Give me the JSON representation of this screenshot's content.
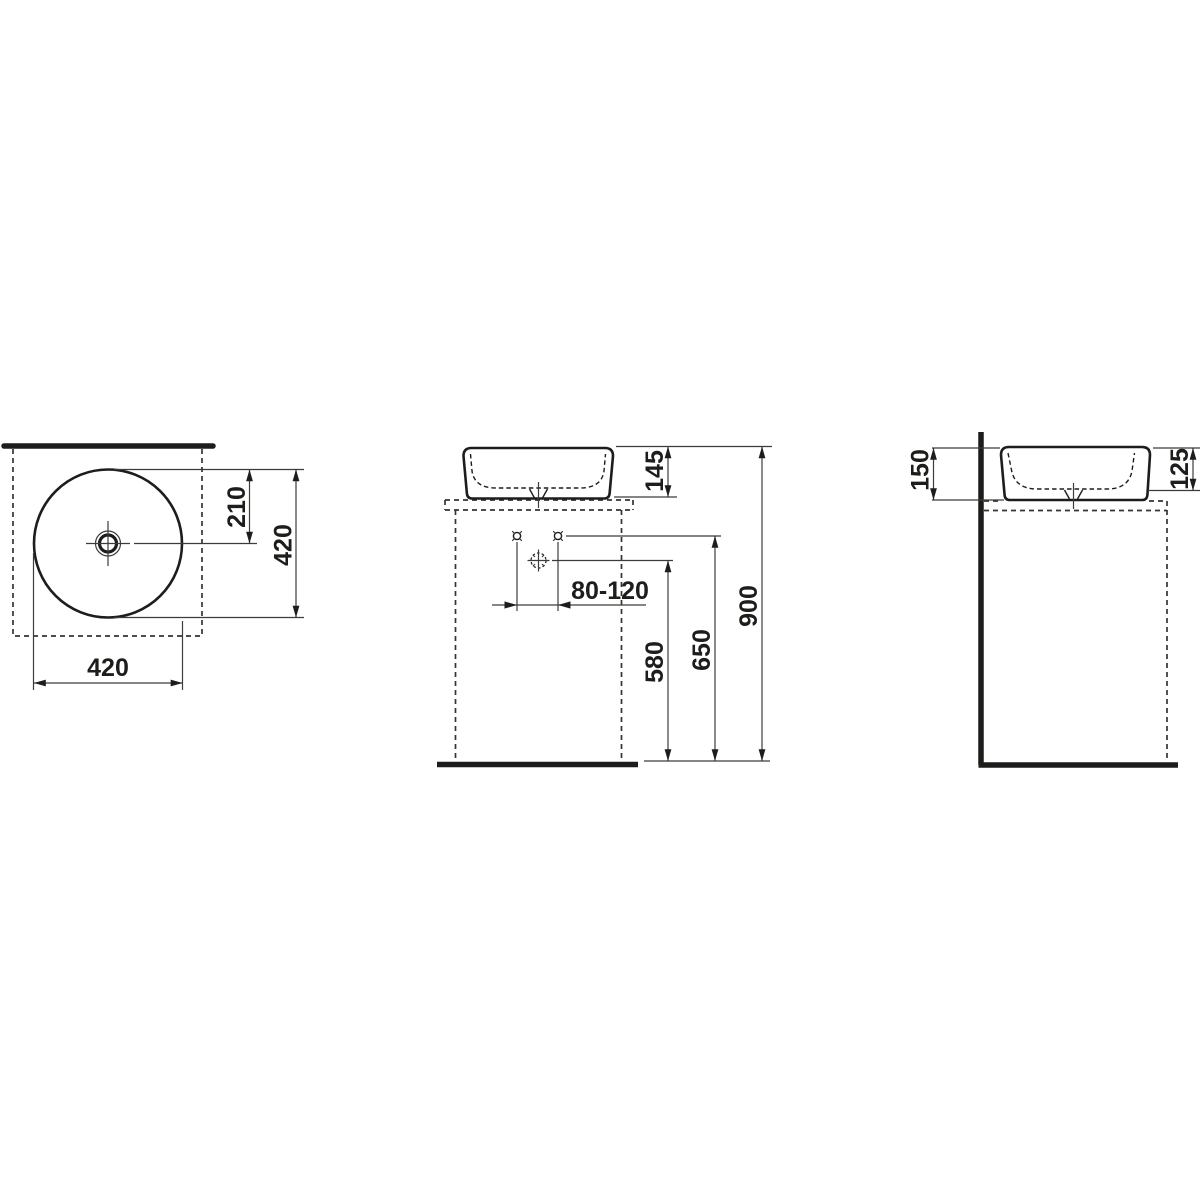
{
  "title": "Countertop washbasin dimensional drawing",
  "colors": {
    "line": "#1d1d1b",
    "thin": "#3c3c3b",
    "background": "#ffffff"
  },
  "views": {
    "top": {
      "name": "top-view",
      "dims": {
        "center_offset": "210",
        "height": "420",
        "width": "420"
      }
    },
    "front": {
      "name": "front-view",
      "dims": {
        "basin_height": "145",
        "faucet_range": "80-120",
        "drain_height": "580",
        "supply_height": "650",
        "rim_height": "900"
      }
    },
    "side": {
      "name": "side-view",
      "dims": {
        "back_height": "150",
        "front_height": "125"
      }
    }
  }
}
